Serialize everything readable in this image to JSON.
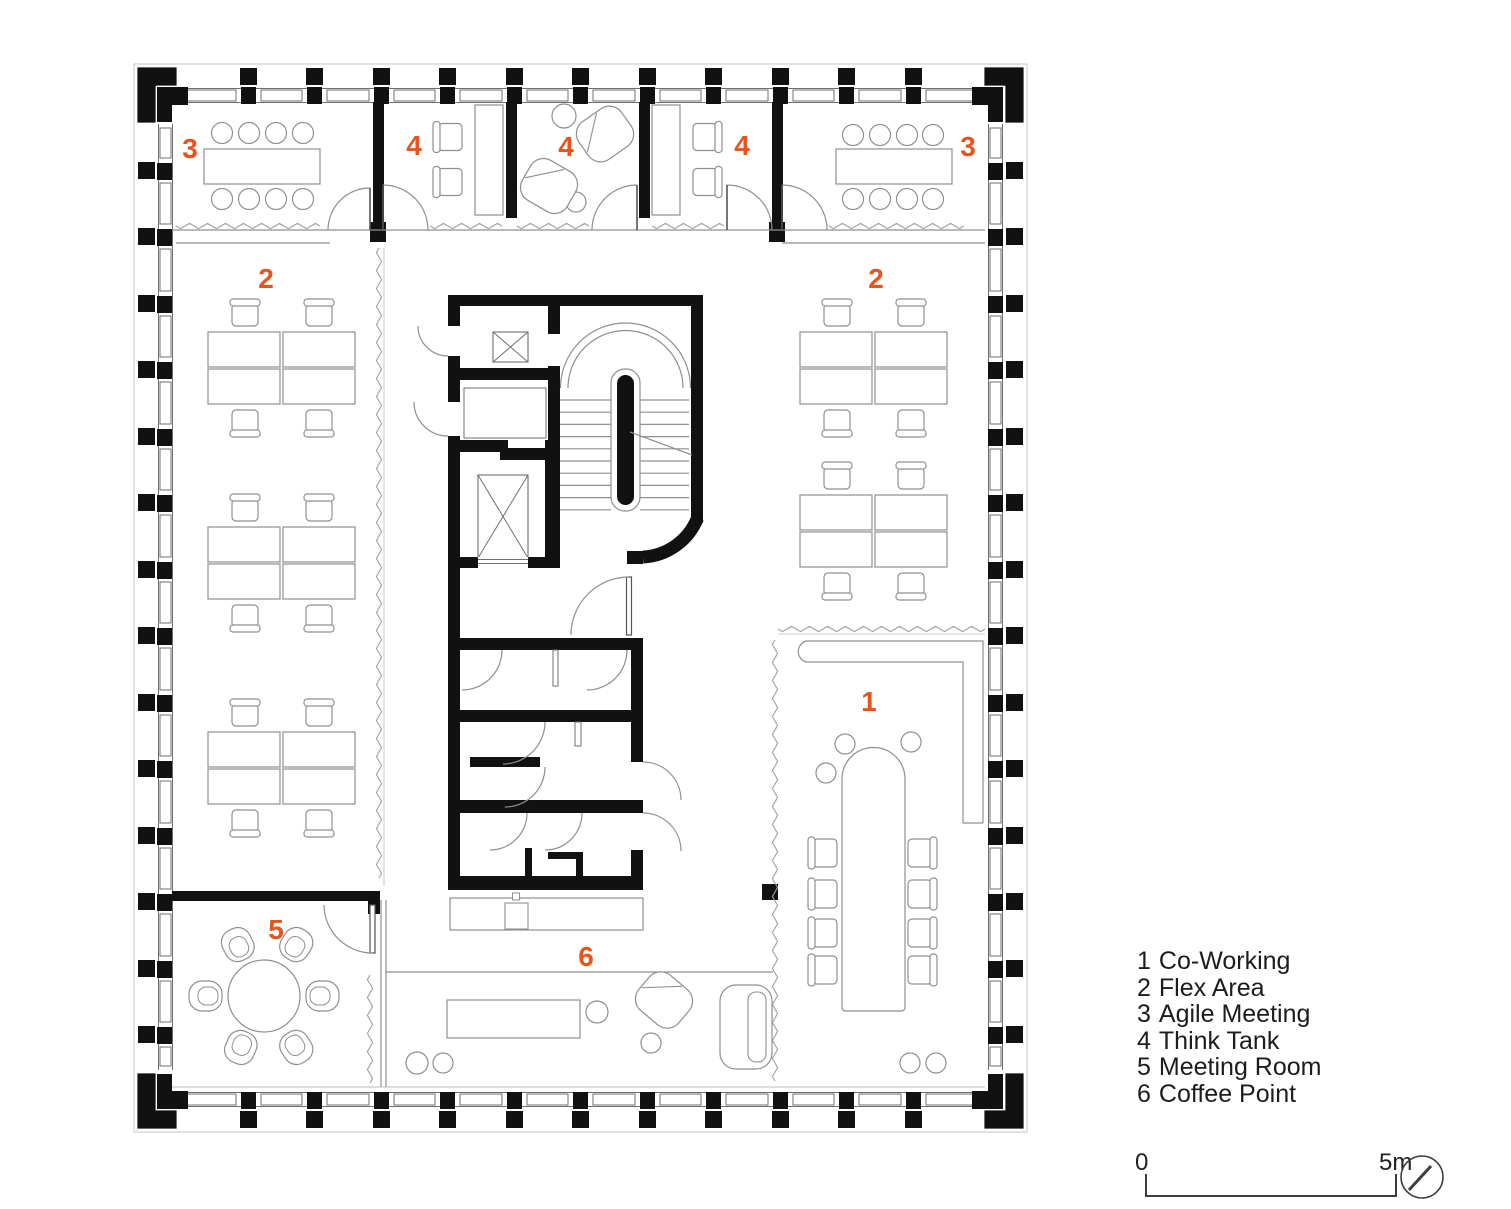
{
  "page": {
    "background": "#ffffff",
    "type": "architectural-floor-plan"
  },
  "plan": {
    "accent_color": "#E8541C",
    "wall_color": "#111111",
    "line_color": "#8f8f8f",
    "frame_color": "#6f6f6f",
    "room_labels": [
      {
        "id": "agile-meeting-left",
        "text": "3",
        "x": 190,
        "y": 158
      },
      {
        "id": "think-tank-a",
        "text": "4",
        "x": 414,
        "y": 155
      },
      {
        "id": "think-tank-b",
        "text": "4",
        "x": 566,
        "y": 156
      },
      {
        "id": "think-tank-c",
        "text": "4",
        "x": 742,
        "y": 155
      },
      {
        "id": "agile-meeting-right",
        "text": "3",
        "x": 968,
        "y": 156
      },
      {
        "id": "flex-area-left",
        "text": "2",
        "x": 266,
        "y": 288
      },
      {
        "id": "flex-area-right",
        "text": "2",
        "x": 876,
        "y": 288
      },
      {
        "id": "co-working",
        "text": "1",
        "x": 869,
        "y": 711
      },
      {
        "id": "meeting-room",
        "text": "5",
        "x": 276,
        "y": 939
      },
      {
        "id": "coffee-point",
        "text": "6",
        "x": 586,
        "y": 966
      }
    ]
  },
  "legend": {
    "items": [
      {
        "number": "1",
        "label": "Co-Working"
      },
      {
        "number": "2",
        "label": "Flex Area"
      },
      {
        "number": "3",
        "label": "Agile Meeting"
      },
      {
        "number": "4",
        "label": "Think Tank"
      },
      {
        "number": "5",
        "label": "Meeting Room"
      },
      {
        "number": "6",
        "label": "Coffee Point"
      }
    ]
  },
  "scale_bar": {
    "start_label": "0",
    "end_label": "5m"
  },
  "compass": {
    "icon": "north-indicator"
  }
}
